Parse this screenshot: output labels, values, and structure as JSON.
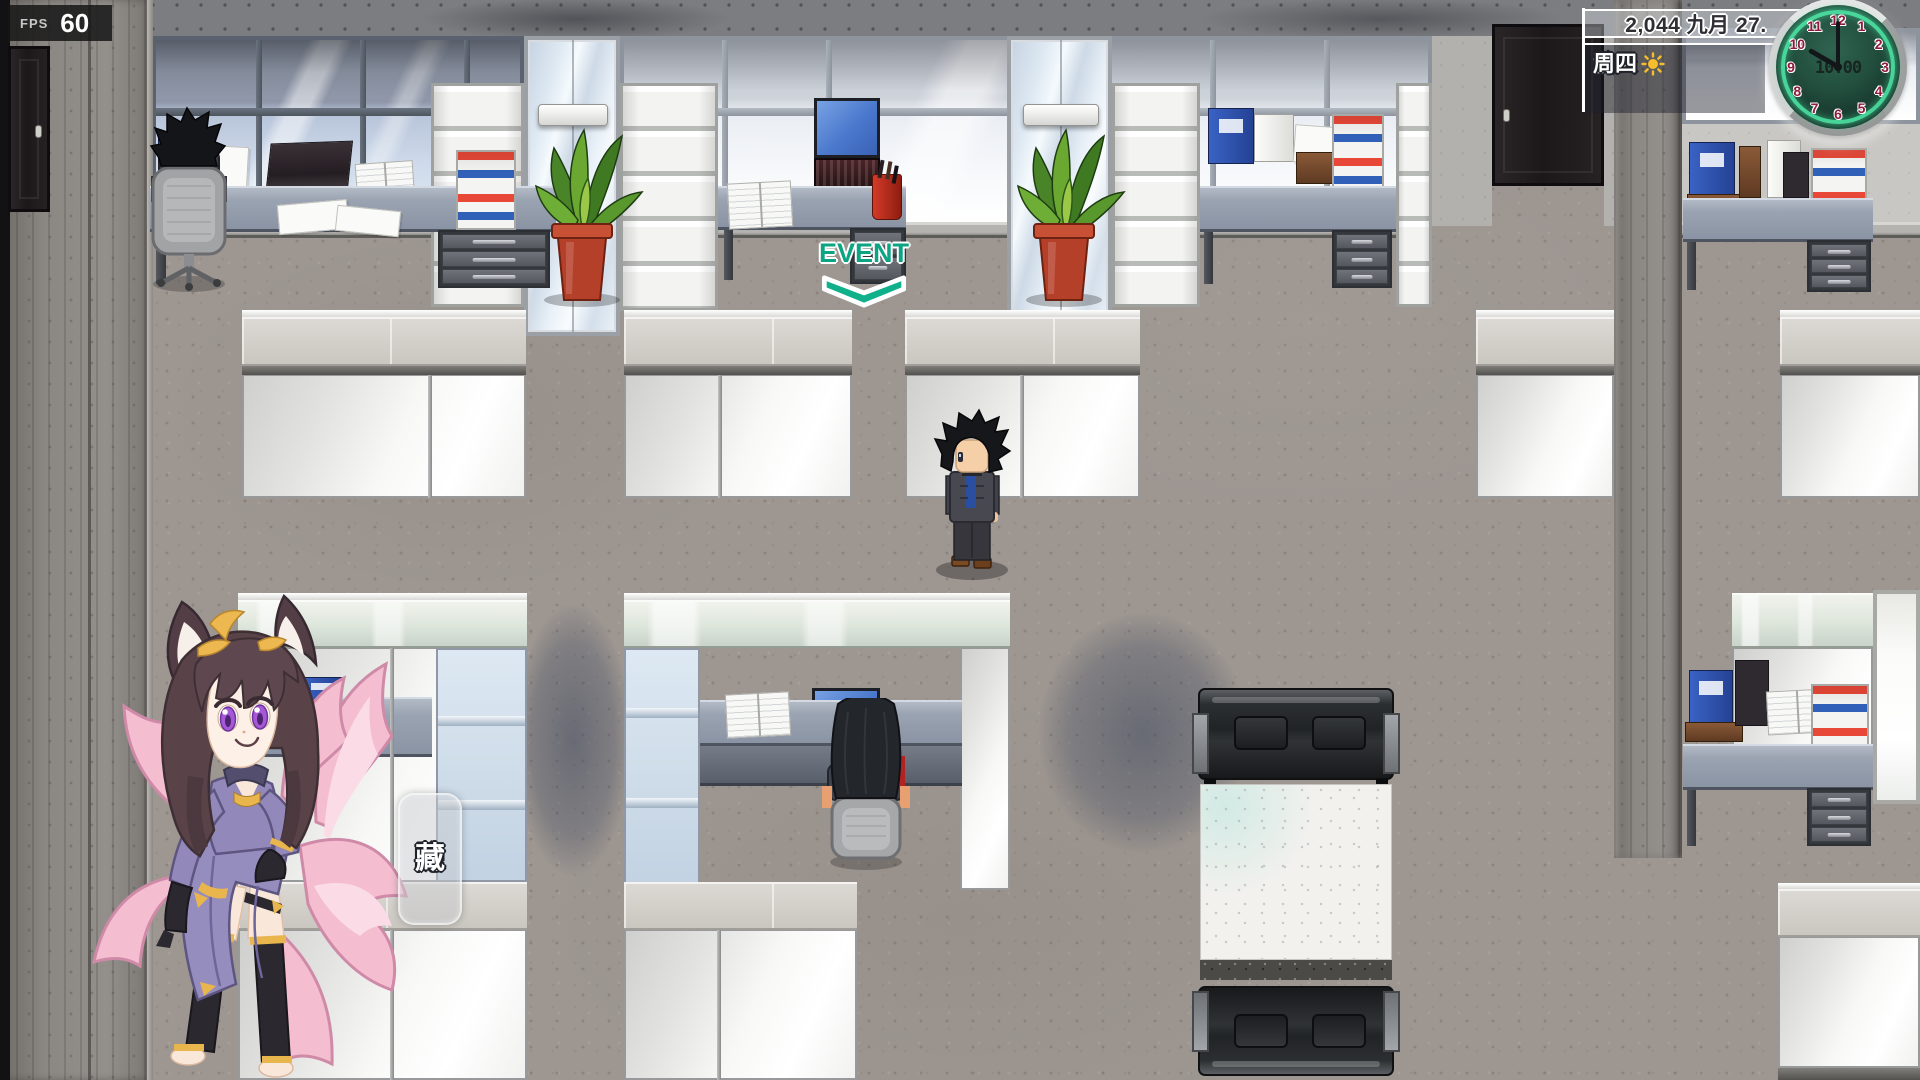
{
  "hud": {
    "fps": {
      "label": "FPS",
      "value": "60"
    },
    "calendar": {
      "date": "2,044 九月 27.",
      "season": "秋天",
      "weekday": "周四"
    },
    "clock": {
      "time": "10:00",
      "numbers": [
        "1",
        "2",
        "3",
        "4",
        "5",
        "6",
        "7",
        "8",
        "9",
        "10",
        "11",
        "12"
      ],
      "hour_angle_deg": 300,
      "minute_angle_deg": 0,
      "colors": {
        "numbers": "#8e1b3c",
        "ring_glow": "#50eeac",
        "face": "#16352b",
        "bezel": "#c9c9c9"
      }
    }
  },
  "overlays": {
    "event_marker": {
      "label": "EVENT",
      "color": "#0ba583"
    },
    "hide_button": {
      "chevrons": "<<<",
      "char_top": "隐",
      "char_bottom": "藏"
    }
  },
  "scene": {
    "colors": {
      "floor": "#9d9691",
      "wall_concrete": "#8f8b87",
      "window_blue": "#cdd9ea",
      "cubicle_white": "#f7f7f5",
      "sofa_black": "#212427",
      "plant_pot": "#b5402a",
      "event_green": "#0ba583"
    }
  }
}
